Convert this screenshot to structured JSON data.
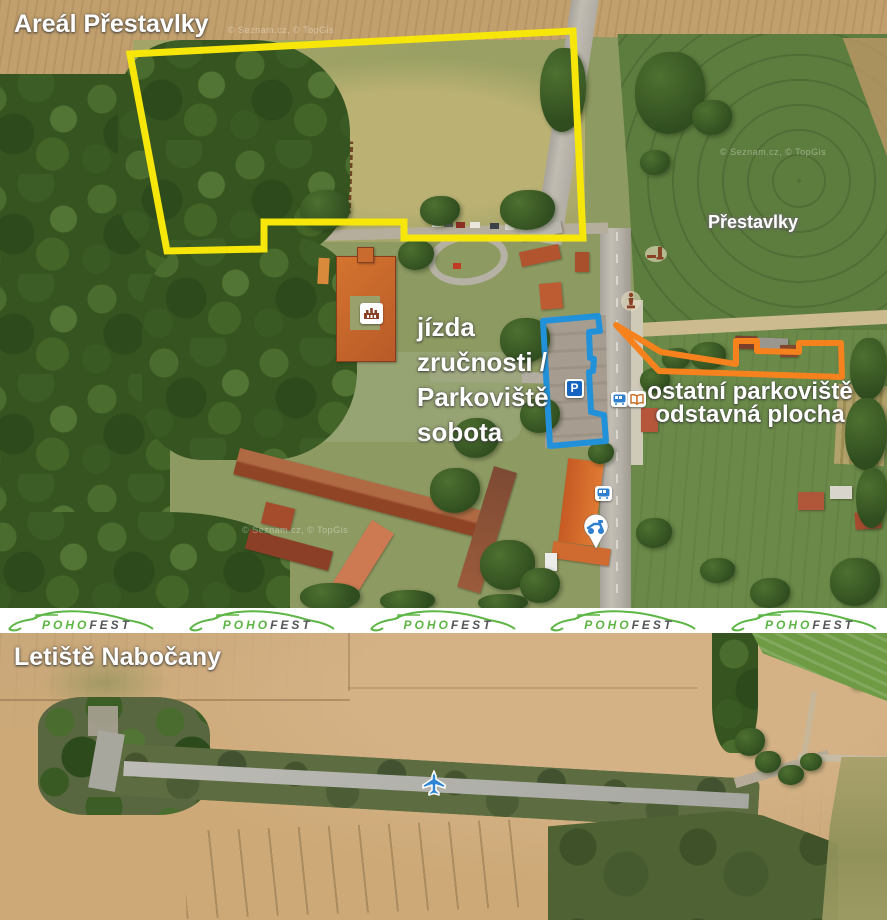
{
  "top_map": {
    "title": "Areál Přestavlky",
    "village_label": "Přestavlky",
    "skill_parking_label": {
      "lines": [
        "jízda",
        "zručnosti /",
        "Parkoviště",
        "sobota"
      ]
    },
    "other_parking_label": {
      "lines": [
        "ostatní parkoviště",
        "odstavná plocha"
      ]
    },
    "parking_badge_letter": "P",
    "watermark": "© Seznam.cz, © TopGis"
  },
  "bottom_map": {
    "title": "Letiště Nabočany"
  },
  "banner": {
    "brand_part_green": "POHO",
    "brand_part_dark": "FEST",
    "logo_count": 5
  },
  "colors": {
    "area_outline_yellow": "#f6e60a",
    "saturday_parking_blue": "#2191d9",
    "other_parking_orange": "#f6821e",
    "brand_green": "#5cb544",
    "brand_gray": "#55565a",
    "plane_blue": "#2e86d4",
    "marker_brown": "#8a4226"
  },
  "icons": {
    "parking_badge": "P-square",
    "bus_stop_badge": "bus-front",
    "library_badge": "open-book",
    "transit_badge": "bus-front",
    "scooter_pin": "scooter-map-pin",
    "chateau_badge": "chateau-building",
    "memorial_marker": "memorial-monument",
    "statue_marker": "statue",
    "airplane_marker": "airplane"
  }
}
